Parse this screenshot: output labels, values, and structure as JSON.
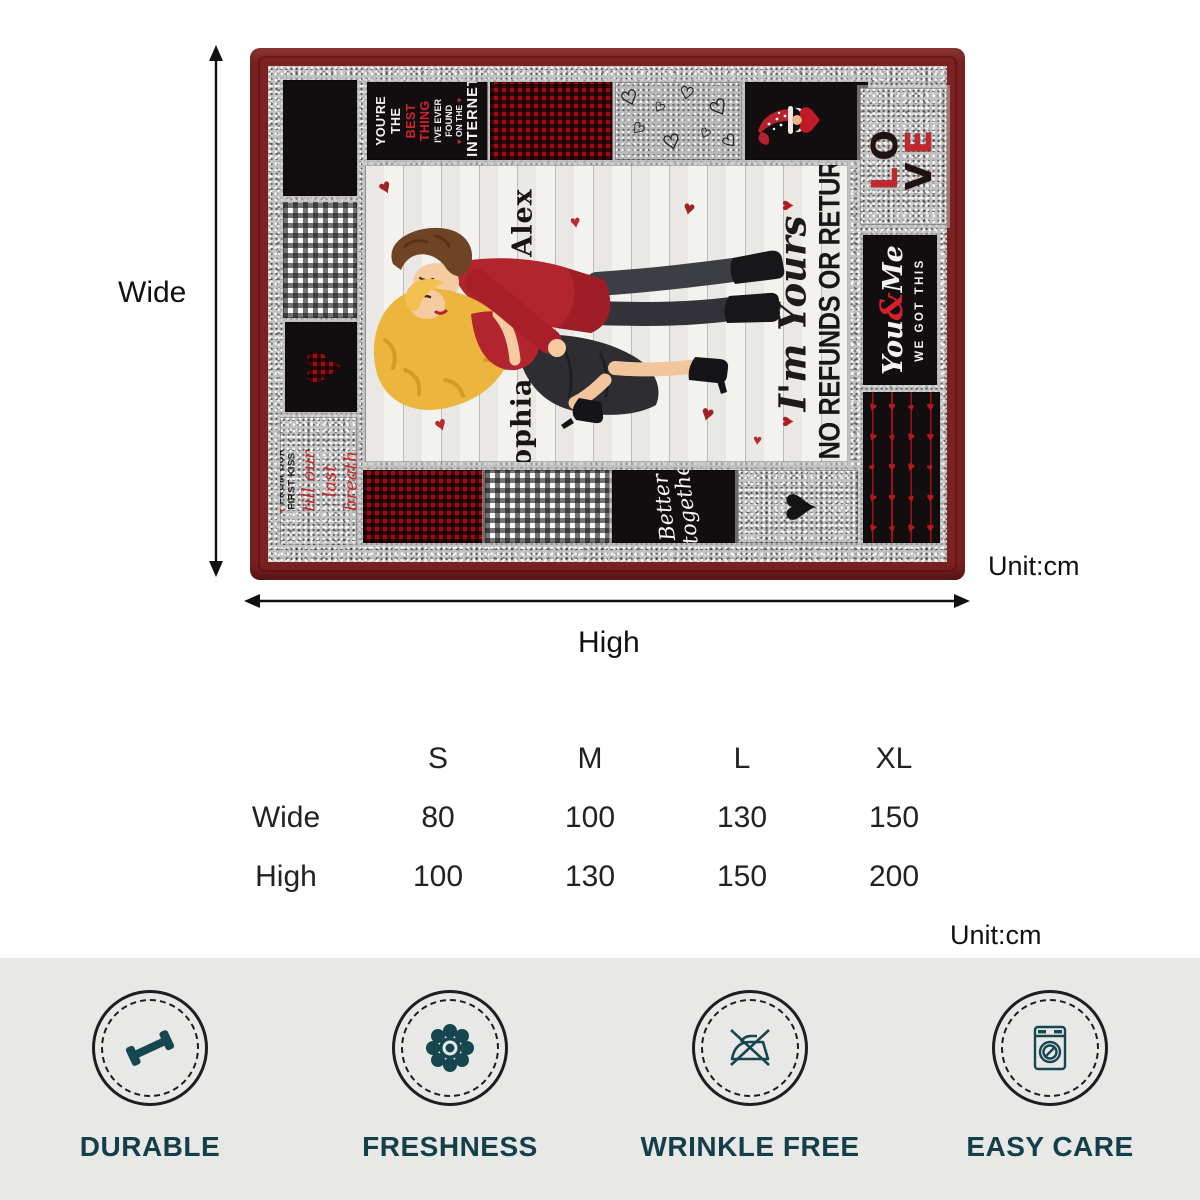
{
  "blanket": {
    "name_top": "Alex",
    "name_bottom": "Sophia",
    "quote_script": "I'm Yours",
    "quote_caps": "NO REFUNDS OR RETURNS",
    "love_script_text": "love love love love",
    "best_thing_lines": [
      "YOU'RE THE",
      "BEST THING",
      "I'VE EVER FOUND",
      "ON THE",
      "INTERNET"
    ],
    "love_letters": [
      "L",
      "O",
      "V",
      "E"
    ],
    "you_me": {
      "word1": "You",
      "amp": "&",
      "word2": "Me",
      "caps": "WE GOT THIS"
    },
    "first_kiss_caps": "FROM OUR FIRST KISS",
    "first_kiss_script": "till our last breath",
    "better_together": [
      "Better",
      "together"
    ]
  },
  "dimensions": {
    "wide": "Wide",
    "high": "High",
    "unit": "Unit:cm"
  },
  "size_table": {
    "columns": [
      "S",
      "M",
      "L",
      "XL"
    ],
    "rows": [
      {
        "label": "Wide",
        "values": [
          "80",
          "100",
          "130",
          "150"
        ]
      },
      {
        "label": "High",
        "values": [
          "100",
          "130",
          "150",
          "200"
        ]
      }
    ],
    "unit": "Unit:cm"
  },
  "features": [
    {
      "icon": "dumbbell-icon",
      "label": "DURABLE"
    },
    {
      "icon": "flower-icon",
      "label": "FRESHNESS"
    },
    {
      "icon": "no-iron-icon",
      "label": "WRINKLE FREE"
    },
    {
      "icon": "washing-machine-icon",
      "label": "EASY CARE"
    }
  ],
  "icons": {
    "heart": "♥",
    "heart_outline": "♡"
  },
  "colors": {
    "maroon": "#7d2121",
    "red_accent": "#c1272d",
    "shirt_red": "#b3252e",
    "silver": "#c2c1c1",
    "teal": "#164650",
    "wood": "#f2f1ed"
  }
}
